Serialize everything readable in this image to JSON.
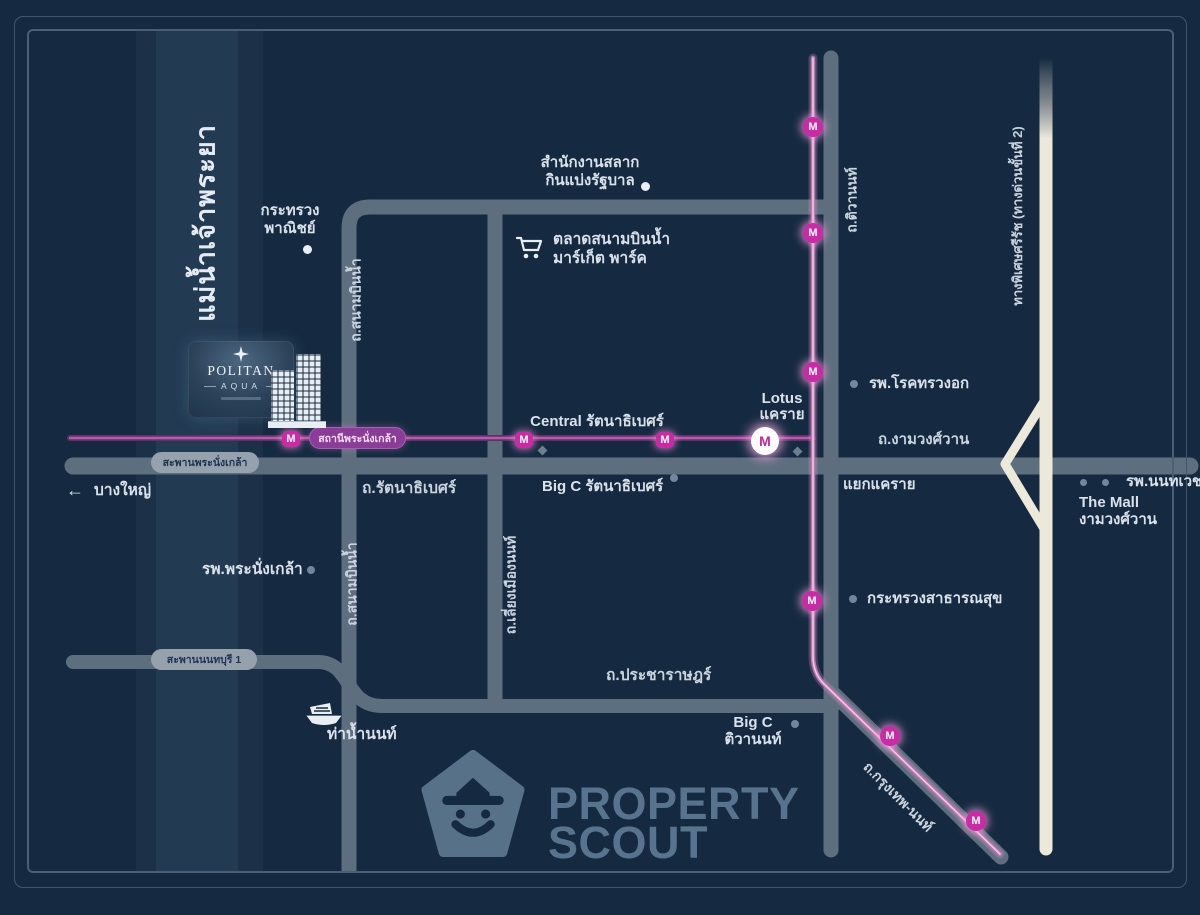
{
  "colors": {
    "background": "#152a40",
    "road_gray": "#5d6f7e",
    "expressway_cream": "#ece8da",
    "mrt_line_pink": "#e9a8d2",
    "mrt_marker_magenta": "#c92ba5",
    "river_band": "#1c3148",
    "label_text": "#d9e2ea"
  },
  "river": {
    "name": "แม่น้ำเจ้าพระยา"
  },
  "project": {
    "brand": "POLITAN",
    "sub_brand": "AQUA"
  },
  "mrt": {
    "m": "M",
    "station_pill": "สถานีพระนั่งเกล้า"
  },
  "roads": {
    "sanambinnam": "ถ.สนามบินน้ำ",
    "liang_mueang_non": "ถ.เลี่ยงเมืองนนท์",
    "tiwanon": "ถ.ติวานนท์",
    "rattanathibet": "ถ.รัตนาธิเบศร์",
    "ngamwongwan": "ถ.งามวงศ์วาน",
    "pracharat": "ถ.ประชาราษฎร์",
    "krungthep_non": "ถ.กรุงเทพ-นนท์",
    "expressway": "ทางพิเศษศรีรัช (ทางด่วนขั้นที่ 2)",
    "bridge_phranangklao": "สะพานพระนั่งเกล้า",
    "bridge_nonthaburi": "สะพานนนทบุรี 1"
  },
  "places": {
    "ministry_commerce_line1": "กระทรวง",
    "ministry_commerce_line2": "พาณิชย์",
    "lottery_line1": "สำนักงานสลาก",
    "lottery_line2": "กินแบ่งรัฐบาล",
    "market_line1": "ตลาดสนามบินน้ำ",
    "market_line2": "มาร์เก็ต พาร์ค",
    "central": "Central รัตนาธิเบศร์",
    "bigc_rattanathibet": "Big C รัตนาธิเบศร์",
    "lotus_line1": "Lotus",
    "lotus_line2": "แคราย",
    "chest_hospital": "รพ.โรคทรวงอก",
    "yaek_khaerai": "แยกแคราย",
    "nonthavej_hospital": "รพ.นนทเวช",
    "the_mall_line1": "The Mall",
    "the_mall_line2": "งามวงศ์วาน",
    "bang_yai": "บางใหญ่",
    "phranangklao_hospital": "รพ.พระนั่งเกล้า",
    "pier_nonthaburi": "ท่าน้ำนนท์",
    "ministry_health": "กระทรวงสาธารณสุข",
    "bigc_tiwanon_line1": "Big C",
    "bigc_tiwanon_line2": "ติวานนท์"
  },
  "symbols": {
    "arrow_left": "←"
  },
  "watermark": {
    "line1": "PROPERTY",
    "line2": "SCOUT"
  }
}
